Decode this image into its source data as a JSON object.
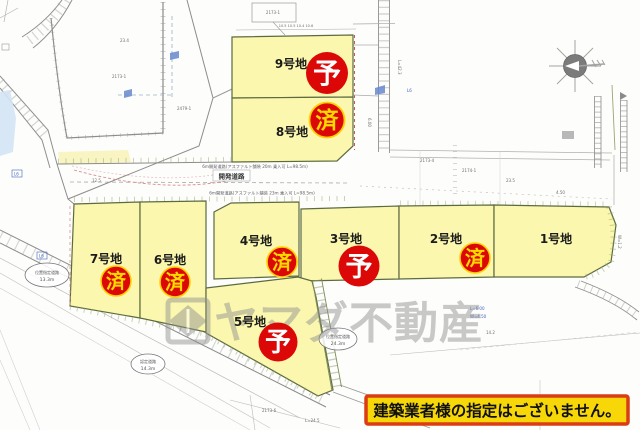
{
  "plots": [
    {
      "label": "1号地",
      "status": ""
    },
    {
      "label": "2号地",
      "status": "済"
    },
    {
      "label": "3号地",
      "status": "予"
    },
    {
      "label": "4号地",
      "status": "済"
    },
    {
      "label": "5号地",
      "status": "予"
    },
    {
      "label": "6号地",
      "status": "済"
    },
    {
      "label": "7号地",
      "status": "済"
    },
    {
      "label": "8号地",
      "status": "済"
    },
    {
      "label": "9号地",
      "status": "予"
    }
  ],
  "road": {
    "label": "開発道路",
    "note_top": "6m開発道路(アスファルト舗装 20m 乗入可 L=98.5m)",
    "note_bottom": "6m開発道路(アスファルト舗装 23m 乗入可 L=98.5m)"
  },
  "balloons": [
    {
      "line1": "位置指定道路",
      "line2": "13.3m"
    },
    {
      "line1": "位置指定道路",
      "line2": "24.3m"
    },
    {
      "line1": "認定道路",
      "line2": "14.3m"
    }
  ],
  "watermark": {
    "company": "ヤマダ不動産"
  },
  "notice": {
    "text": "建築業者様の指定はございません。"
  },
  "micro": [
    "2173-1",
    "2173-1",
    "2479-1",
    "23.4",
    "L=42.3",
    "6.00",
    "2173-4",
    "2174-1",
    "23.5",
    "4.50",
    "12.5",
    "10.5  10.5  10.4  10.6",
    "2173-6",
    "L=24.5",
    "14.2",
    "L6",
    "L6",
    "L6",
    "W=1.2",
    "L=6.00",
    "W=4.50"
  ],
  "colors": {
    "plot_fill": "#fbf7ae",
    "plot_border": "#5c6b3f",
    "badge_red": "#dc0808",
    "badge_yo_text": "#ffffff",
    "badge_sumi_text": "#ffd900",
    "notice_bg": "#f7d708",
    "notice_border": "#dc3c14",
    "watermark_gray": "#8f8f8f"
  }
}
